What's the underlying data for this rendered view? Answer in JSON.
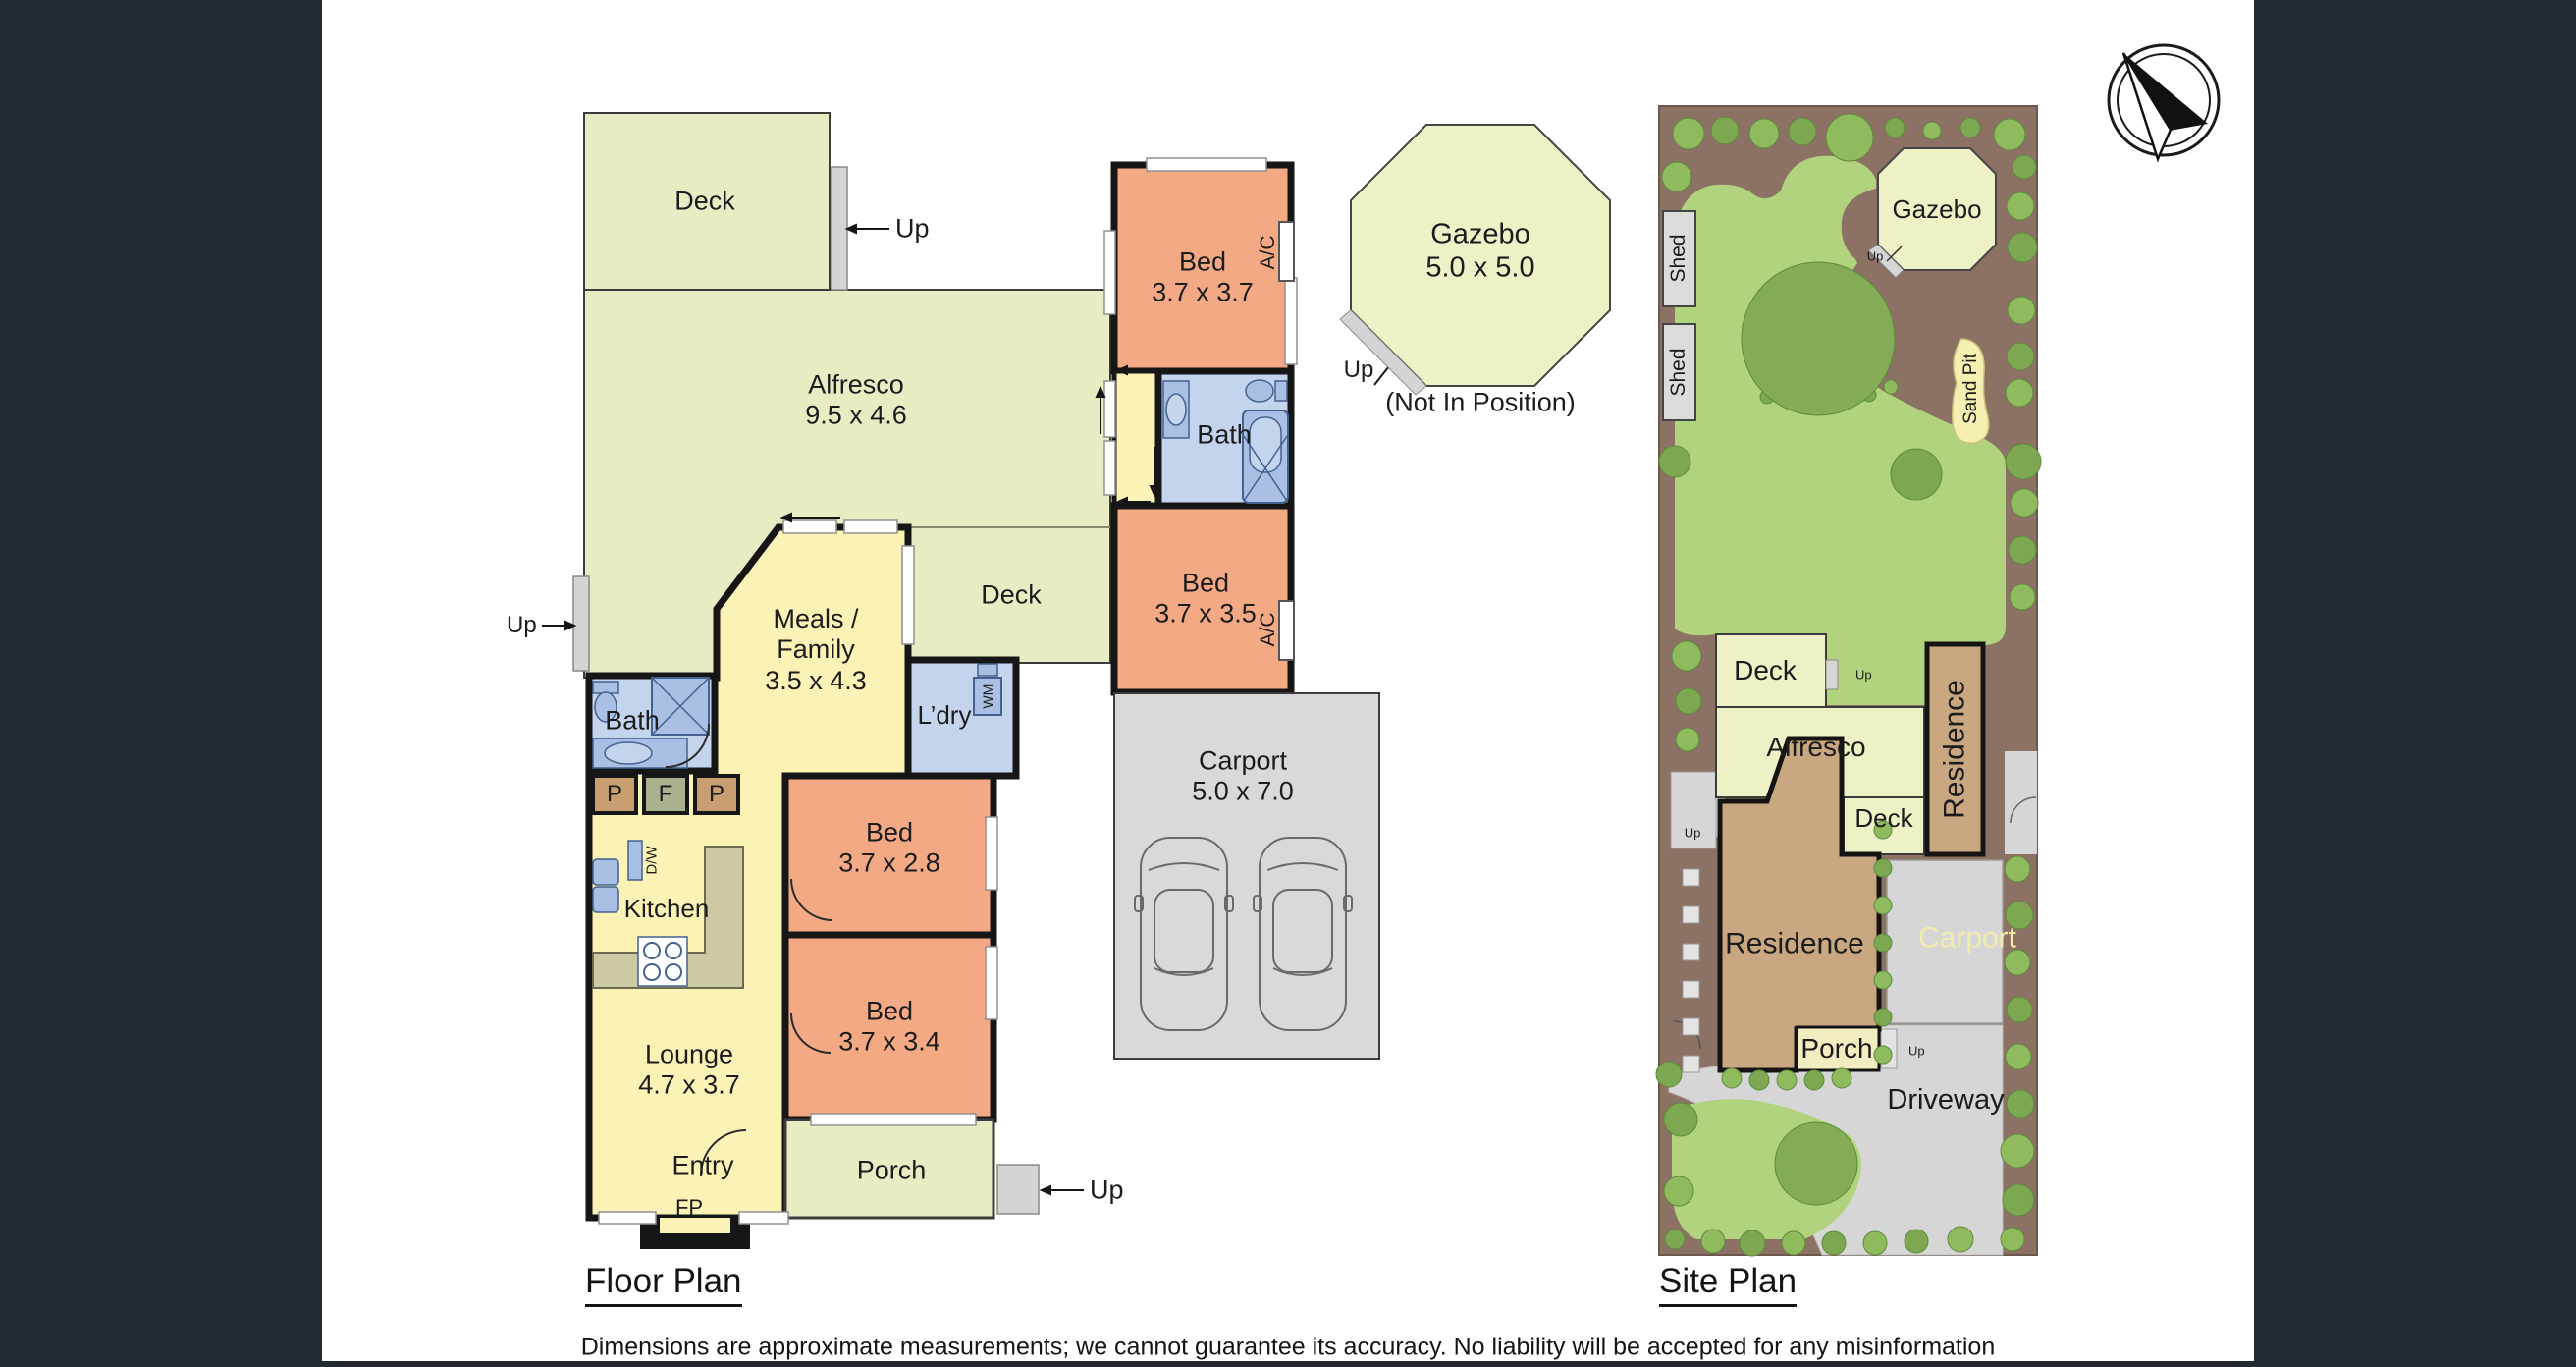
{
  "titles": {
    "floor_plan": "Floor Plan",
    "site_plan": "Site Plan"
  },
  "disclaimer": "Dimensions are approximate measurements; we cannot guarantee its accuracy. No liability will be accepted for any misinformation",
  "colors": {
    "outdoor": "#e9ecc3",
    "living": "#fbf2b6",
    "bedroom": "#f2a984",
    "wet_area": "#c5d4ed",
    "fixture": "#a9c0e4",
    "bench": "#cdc9a5",
    "pantry": "#c99f72",
    "fridge": "#a9b18e",
    "hard_surface": "#d9d9d9",
    "wall": "#161616",
    "site_border": "#8b7265",
    "lawn": "#b2d37e",
    "tree": "#8fba5e",
    "tree_dark": "#7da851",
    "site_residence": "#c9a780",
    "side_panel": "#232931",
    "carport_label_text": "#f1ecac"
  },
  "floor_plan": {
    "up_label": "Up",
    "rooms": {
      "deck_top": {
        "lines": [
          "Deck"
        ]
      },
      "alfresco": {
        "lines": [
          "Alfresco",
          "9.5 x 4.6"
        ]
      },
      "bed1": {
        "lines": [
          "Bed",
          "3.7 x 3.7"
        ]
      },
      "bath_right": {
        "lines": [
          "Bath"
        ]
      },
      "bed2": {
        "lines": [
          "Bed",
          "3.7 x 3.5"
        ]
      },
      "deck_mid": {
        "lines": [
          "Deck"
        ]
      },
      "meals": {
        "lines": [
          "Meals /",
          "Family",
          "3.5 x 4.3"
        ]
      },
      "laundry": {
        "lines": [
          "L’dry"
        ]
      },
      "bath_left": {
        "lines": [
          "Bath"
        ]
      },
      "kitchen": {
        "lines": [
          "Kitchen"
        ]
      },
      "bed3": {
        "lines": [
          "Bed",
          "3.7 x 2.8"
        ]
      },
      "bed4": {
        "lines": [
          "Bed",
          "3.7 x 3.4"
        ]
      },
      "lounge": {
        "lines": [
          "Lounge",
          "4.7 x 3.7"
        ]
      },
      "entry": {
        "lines": [
          "Entry"
        ]
      },
      "porch": {
        "lines": [
          "Porch"
        ]
      },
      "carport": {
        "lines": [
          "Carport",
          "5.0 x 7.0"
        ]
      },
      "gazebo": {
        "lines": [
          "Gazebo",
          "5.0 x 5.0"
        ]
      }
    },
    "annotations": {
      "ac": "A/C",
      "wm": "WM",
      "dw": "D/W",
      "fp": "FP",
      "pantry": "P",
      "fridge": "F",
      "not_in_position": "(Not In Position)"
    }
  },
  "site_plan": {
    "up_label": "Up",
    "labels": {
      "shed1": "Shed",
      "shed2": "Shed",
      "gazebo": "Gazebo",
      "sand_pit": "Sand Pit",
      "deck_upper": "Deck",
      "alfresco": "Alfresco",
      "deck_lower": "Deck",
      "residence_right": "Residence",
      "residence_main": "Residence",
      "carport": "Carport",
      "porch": "Porch",
      "driveway": "Driveway"
    }
  }
}
